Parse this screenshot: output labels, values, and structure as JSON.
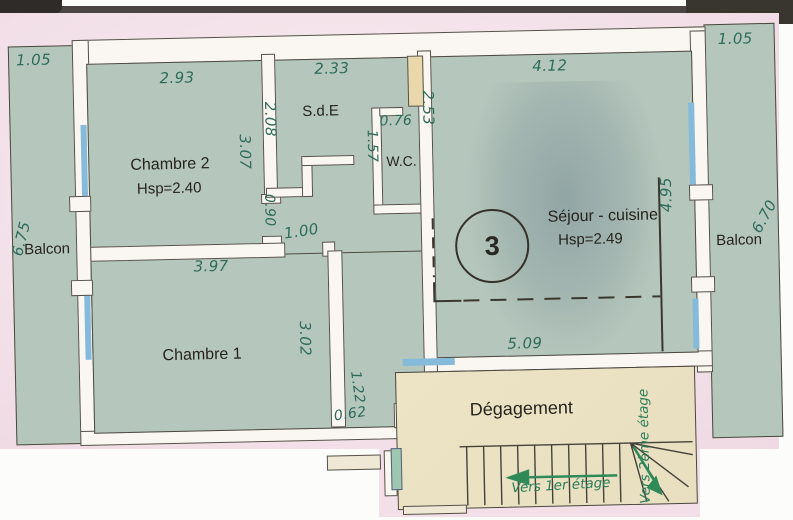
{
  "rooms": {
    "chambre2": {
      "name": "Chambre 2",
      "hsp": "Hsp=2.40"
    },
    "chambre1": {
      "name": "Chambre 1"
    },
    "sde": {
      "name": "S.d.E"
    },
    "wc": {
      "name": "W.C."
    },
    "sejour": {
      "name": "Séjour - cuisine",
      "hsp": "Hsp=2.49",
      "lot_number": "3"
    },
    "degagement": {
      "name": "Dégagement"
    },
    "balcon_left": {
      "name": "Balcon"
    },
    "balcon_right": {
      "name": "Balcon"
    }
  },
  "dims": {
    "balcon_left_w": "1.05",
    "balcon_left_l": "6.75",
    "ch2_w": "2.93",
    "ch2_d": "3.07",
    "sde_w": "2.33",
    "sde_d": "2.08",
    "wc_w": "0.76",
    "wc_d": "1.57",
    "sejour_w": "4.12",
    "sejour_d_left": "2.53",
    "sejour_d_right": "4.95",
    "sejour_bottom": "5.09",
    "balcon_right_w": "1.05",
    "balcon_right_l": "6.70",
    "door_ch2": "0.90",
    "door_ch1": "1.00",
    "ch1_w": "3.97",
    "ch1_d": "3.02",
    "hall_w": "1.22",
    "hall_step": "0.62"
  },
  "stairs": {
    "to_first_floor": "Vers 1er étage",
    "to_second_floor": "Vers 2ème étage"
  },
  "colors": {
    "paper": "#f3e1e9",
    "room_fill": "#b5c7bc",
    "degagement_fill": "#ece4c4",
    "wall_fill": "#faf6f1",
    "line": "#4c483f",
    "window_blue": "#85badb",
    "door_tan": "#e8d8ac",
    "dim_text": "#2e6b5c",
    "arrow_green": "#2f8a58"
  }
}
